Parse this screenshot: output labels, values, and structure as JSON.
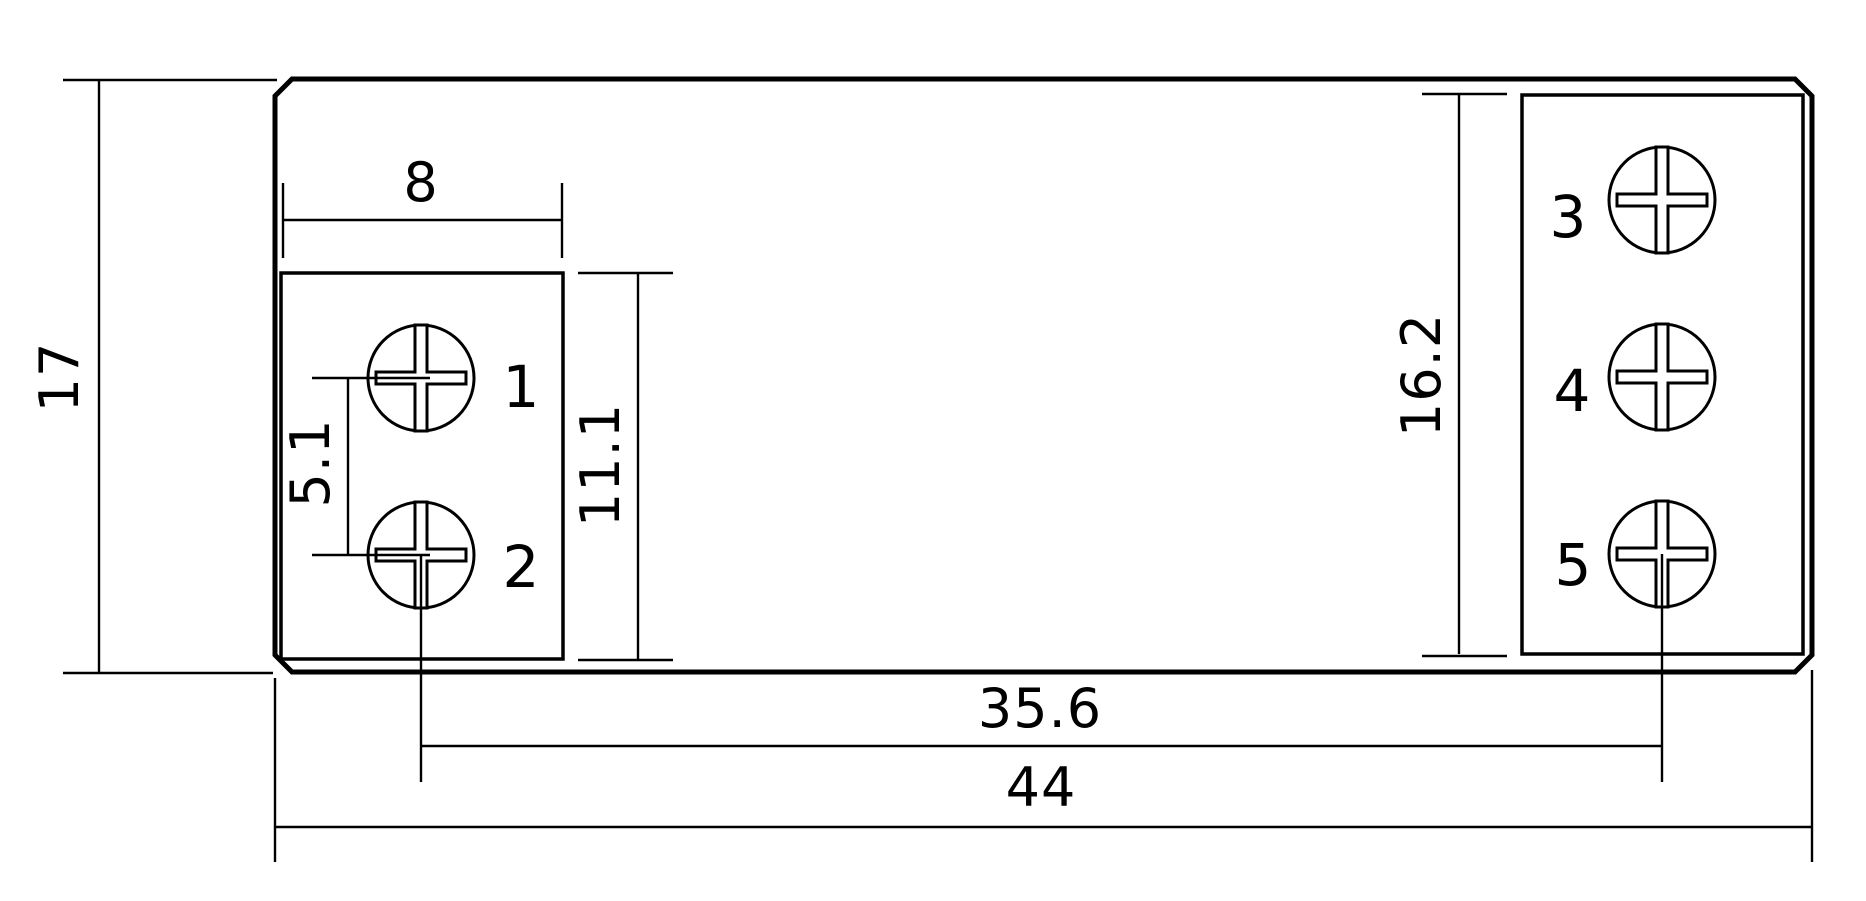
{
  "drawing": {
    "title": "terminal-device-dimension-drawing",
    "background": "#ffffff",
    "line_color": "#000000",
    "label_color": "#ee2429",
    "dimensions": {
      "overall_height": "17",
      "left_box_width": "8",
      "screw_pitch": "5.1",
      "left_box_height": "11.1",
      "right_box_height": "16.2",
      "screw_span": "35.6",
      "overall_width": "44"
    },
    "terminals": [
      "1",
      "2",
      "3",
      "4",
      "5"
    ]
  }
}
